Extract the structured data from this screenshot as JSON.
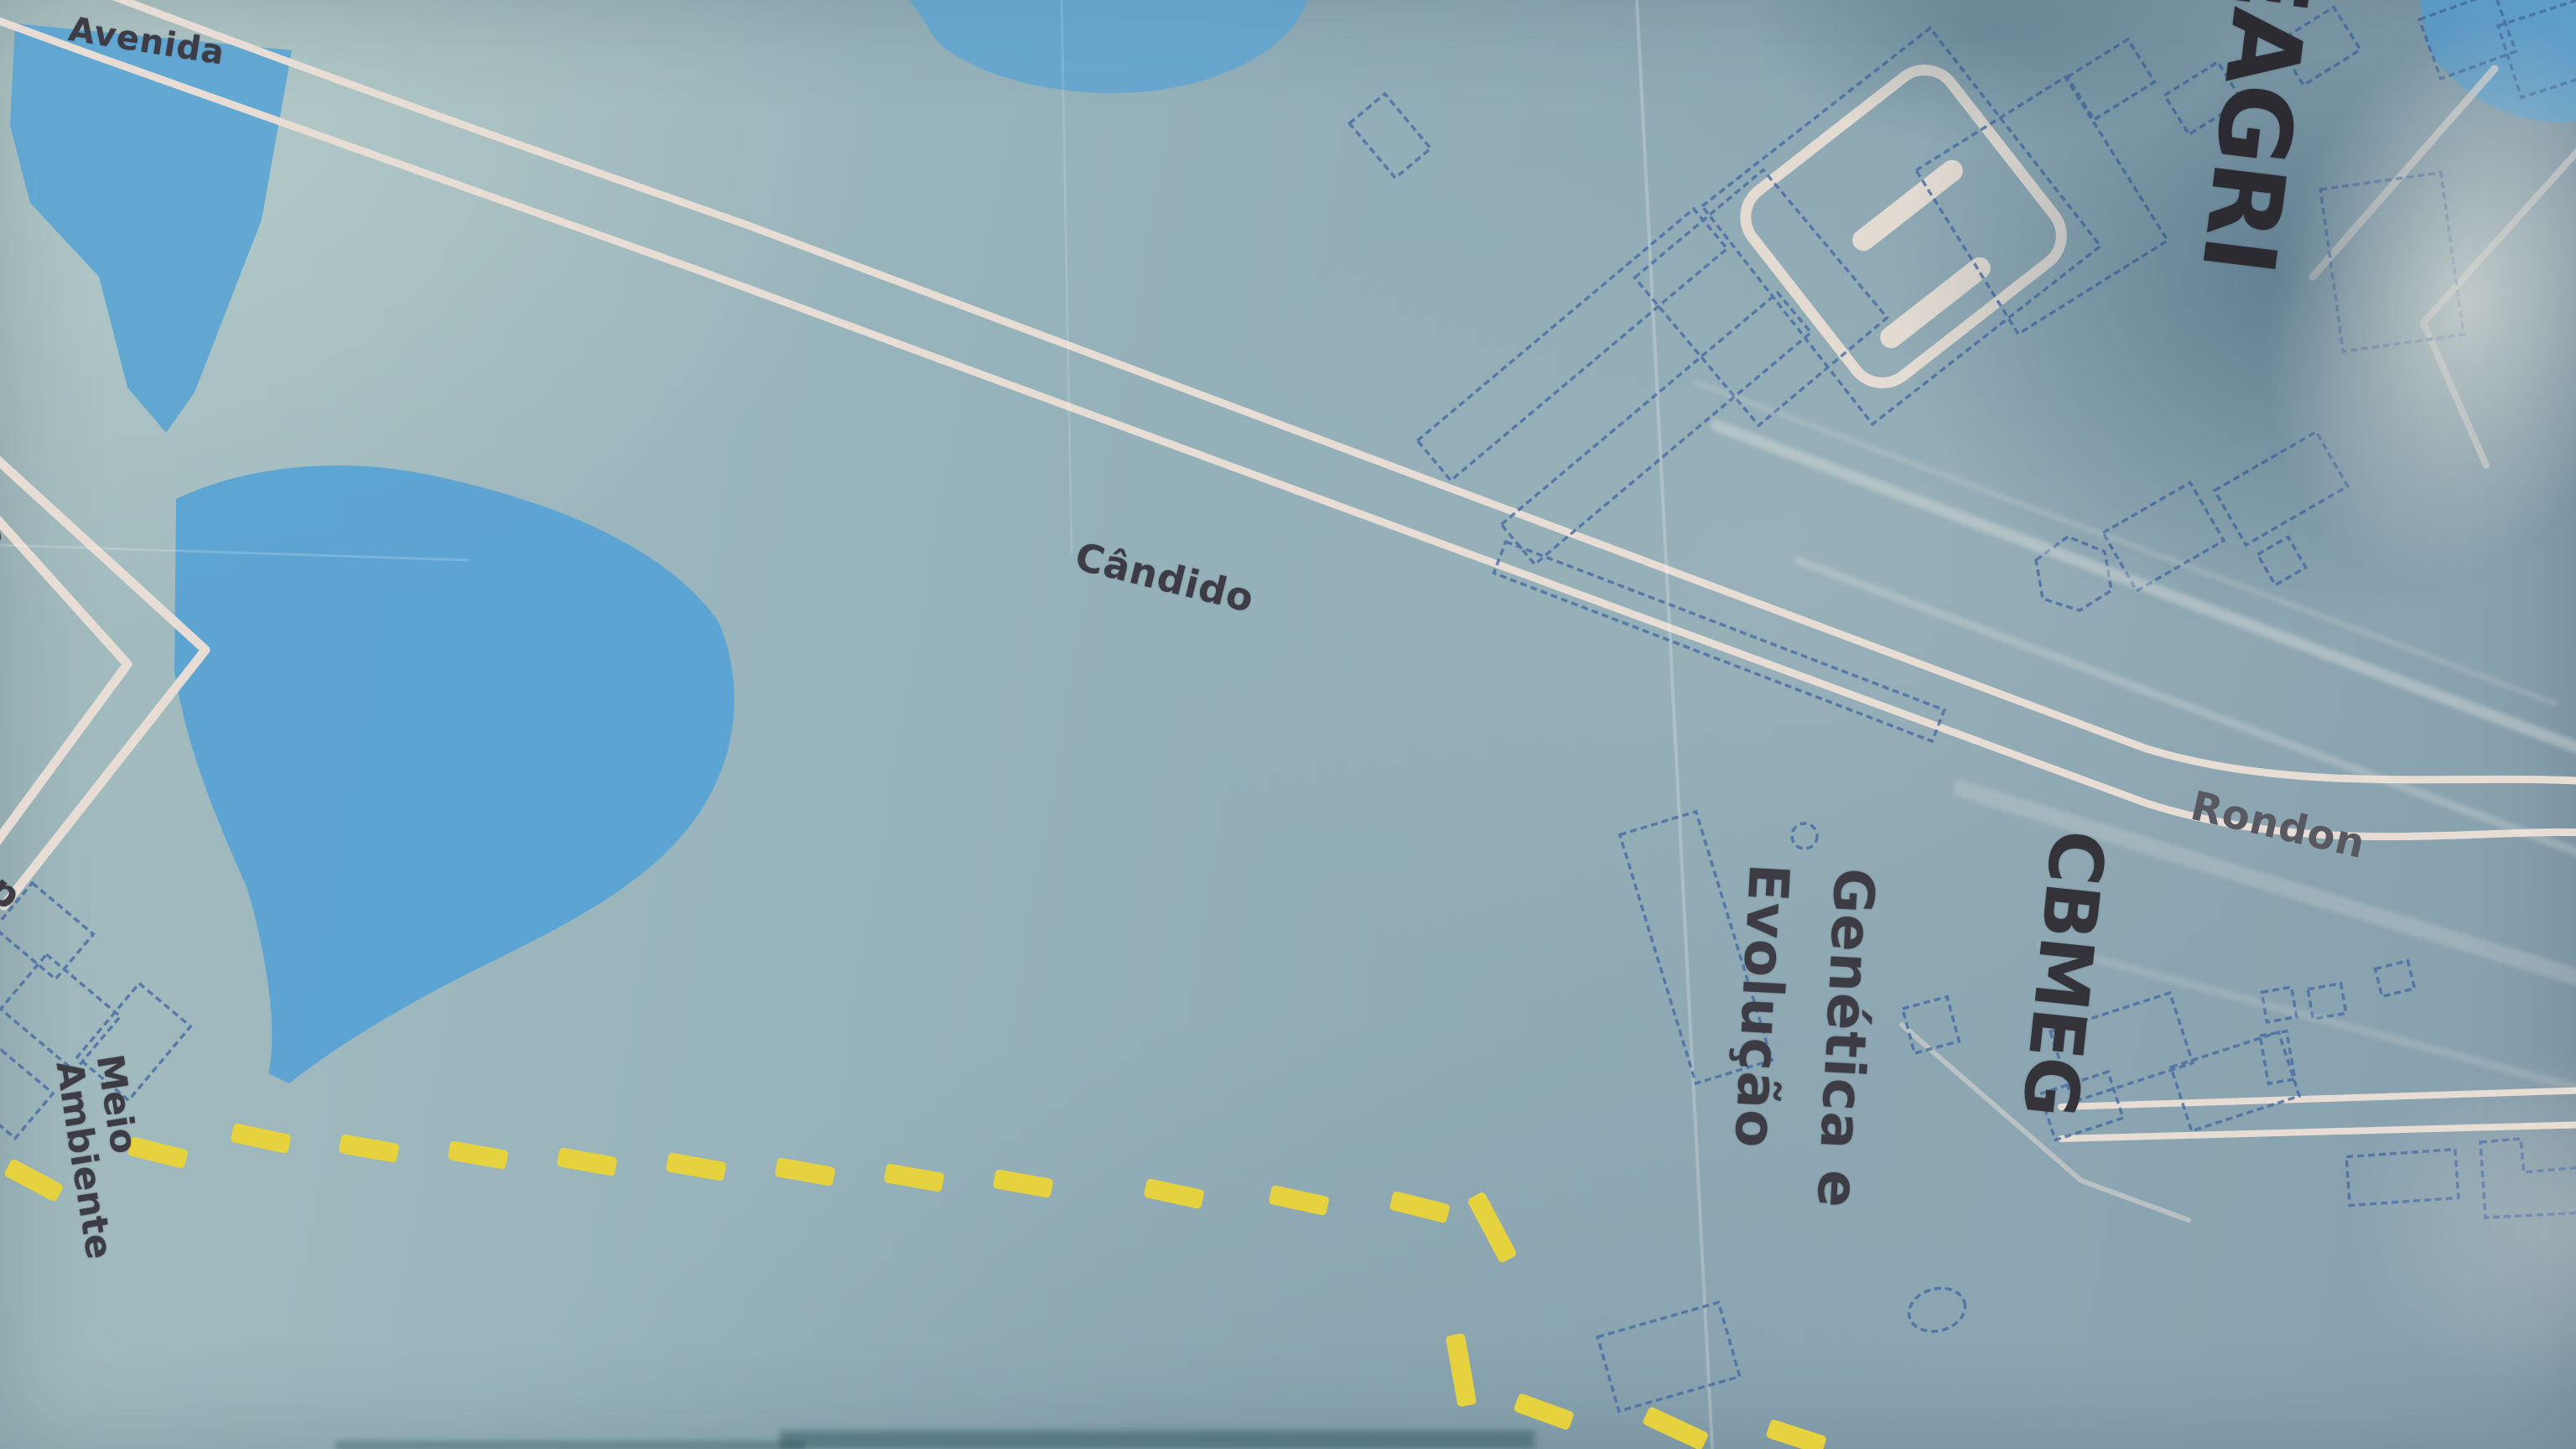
{
  "theme": {
    "background": "#93afb9",
    "water": "#55a2d5",
    "road": "#e8ddd4",
    "building_outline": "#476ba3",
    "trail_yellow": "#e6d23e",
    "label_dark": "#3d3c44",
    "label_faded": "#585860",
    "title_dark": "#2c2b32"
  },
  "labels": {
    "street": {
      "avenida": "Avenida",
      "candido": "Cândido",
      "rondon": "Rondon"
    },
    "buildings": {
      "feagri": "EAGRI",
      "cbmeg": "CBMEG",
      "genetica_line1": "Genética e",
      "genetica_line2": "Evolução",
      "meio_line1": "Meio",
      "meio_line2": "Ambiente"
    },
    "edge_fragments": {
      "left_upper": "co",
      "left_lower": "ap"
    }
  }
}
